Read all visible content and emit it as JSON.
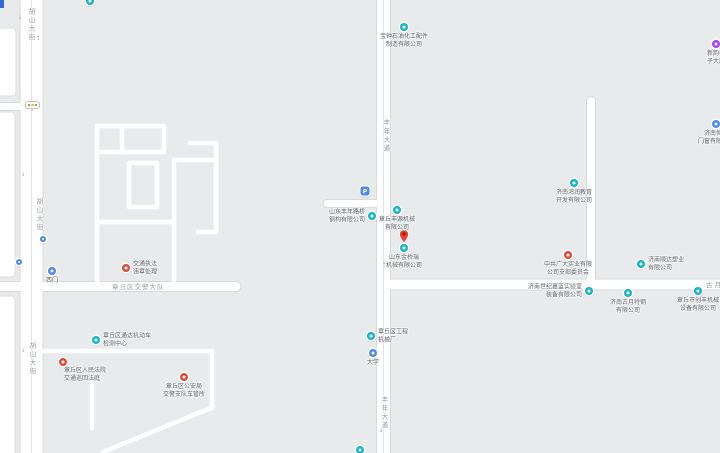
{
  "map": {
    "colors": {
      "background": "#e9eaec",
      "road": "#ffffff",
      "road_casing": "#d7d9dd",
      "block_fill": "#ffffff",
      "poi_label": "#5c6066",
      "road_label": "#94989d",
      "teal_icon": "#12b5cb",
      "blue_icon": "#4a89f3",
      "red_icon": "#df4b3b",
      "purple_icon": "#a142f4",
      "pin_red": "#ea4335"
    },
    "glyphs": {
      "arrow_up": "↑",
      "arrow_down": "↓",
      "parking": "P"
    }
  },
  "roads": {
    "hushan_street": "胡山大街",
    "fengnian_avenue": "丰年大道",
    "guyue_road": "古月路",
    "compound_area": "章丘区交警大队"
  },
  "pois": [
    {
      "label": "宝钟石油化工配件\n制造有限公司",
      "icon": "company-teal"
    },
    {
      "label": "新韵电\n子大厦",
      "icon": "company-purple"
    },
    {
      "label": "济南恒达\n门窗有限公司",
      "icon": "company-blue"
    },
    {
      "label": "济南鸿润教育\n开发有限公司",
      "icon": "company-teal"
    },
    {
      "label": "山东丰年路桥\n钢构有限公司",
      "icon": "company-teal"
    },
    {
      "label": "章丘丰源机械\n有限公司",
      "icon": "company-teal"
    },
    {
      "label": "山东金桥瑞\n机械有限公司",
      "icon": "red-pin"
    },
    {
      "label": "中共广大实业有限\n公司支部委员会",
      "icon": "company-red"
    },
    {
      "label": "济南顺达塑业\n有限公司",
      "icon": "company-teal"
    },
    {
      "label": "济南世纪嘉蓝实验室\n装备有限公司",
      "icon": "company-teal"
    },
    {
      "label": "济南古月特钢\n有限公司",
      "icon": "company-teal"
    },
    {
      "label": "章丘市创丰机械\n设备有限公司",
      "icon": "company-teal"
    },
    {
      "label": "西门",
      "icon": "gate-blue"
    },
    {
      "label": "交通执法\n违章处理",
      "icon": "service-red"
    },
    {
      "label": "章丘区通达机动车\n检测中心",
      "icon": "company-teal"
    },
    {
      "label": "章丘区人民法院\n交通巡回法庭",
      "icon": "gov-red"
    },
    {
      "label": "章丘区公安局\n交警支队车管所",
      "icon": "gov-red"
    },
    {
      "label": "章丘区工程\n机械厂",
      "icon": "company-teal"
    },
    {
      "label": "大学",
      "icon": "stop-blue"
    }
  ]
}
